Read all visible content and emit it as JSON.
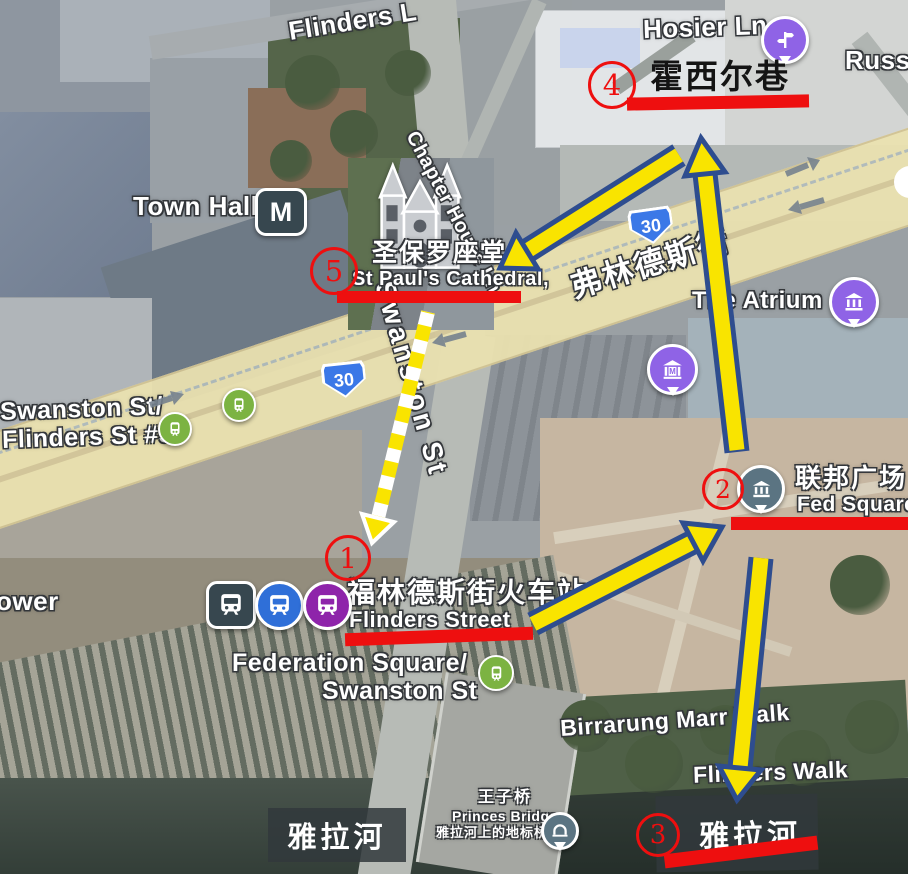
{
  "colors": {
    "annotation_red": "#ee0f0f",
    "arrow_yellow": "#f9e400",
    "arrow_outline": "#2e4d8f",
    "road_yellow": "#ebe2b0",
    "tram_green": "#7cb342",
    "pin_purple": "#8f63e6",
    "pin_slate": "#5b7482",
    "metro_dark": "#37474f",
    "train_blue": "#2f6fd8",
    "train_purple": "#8e24aa",
    "shield_blue": "#3b78e7",
    "traffic_gray": "#76828e"
  },
  "streets": {
    "flinders_lane": "Flinders L",
    "chapter_house_ln": "Chapter House Ln",
    "hosier_ln": "Hosier Ln",
    "russell_st": "Russe",
    "town_hall": "Town Hall",
    "the_atrium": "The Atrium",
    "swanston_st": "Swanston St",
    "road_zh": "弗林德斯街",
    "route_shield": "30",
    "tower": "ower",
    "birrarung_marr_walk": "Birrarung Marr Walk",
    "flinders_walk": "Flinders Walk"
  },
  "stops": {
    "tram5_line1": "Swanston St/",
    "tram5_line2": "Flinders St #5",
    "fedsq_line1": "Federation Square/",
    "fedsq_line2": "Swanston St"
  },
  "places": {
    "cathedral_zh": "圣保罗座堂",
    "cathedral_en": "St Paul's Cathedral,",
    "station_zh": "福林德斯街火车站",
    "station_en": "Flinders Street",
    "fed_square_zh": "联邦广场",
    "fed_square_en": "Fed Square",
    "river_zh": "雅拉河",
    "bridge_zh": "王子桥",
    "bridge_en": "Princes Bridge",
    "bridge_desc_zh": "雅拉河上的地标桥梁"
  },
  "pins": {
    "town_hall_m": "M",
    "museum_m": "M"
  },
  "route_steps": {
    "s1": {
      "num": "1"
    },
    "s2": {
      "num": "2"
    },
    "s3": {
      "num": "3"
    },
    "s4": {
      "num": "4",
      "label_zh": "霍西尔巷"
    },
    "s5": {
      "num": "5"
    }
  }
}
